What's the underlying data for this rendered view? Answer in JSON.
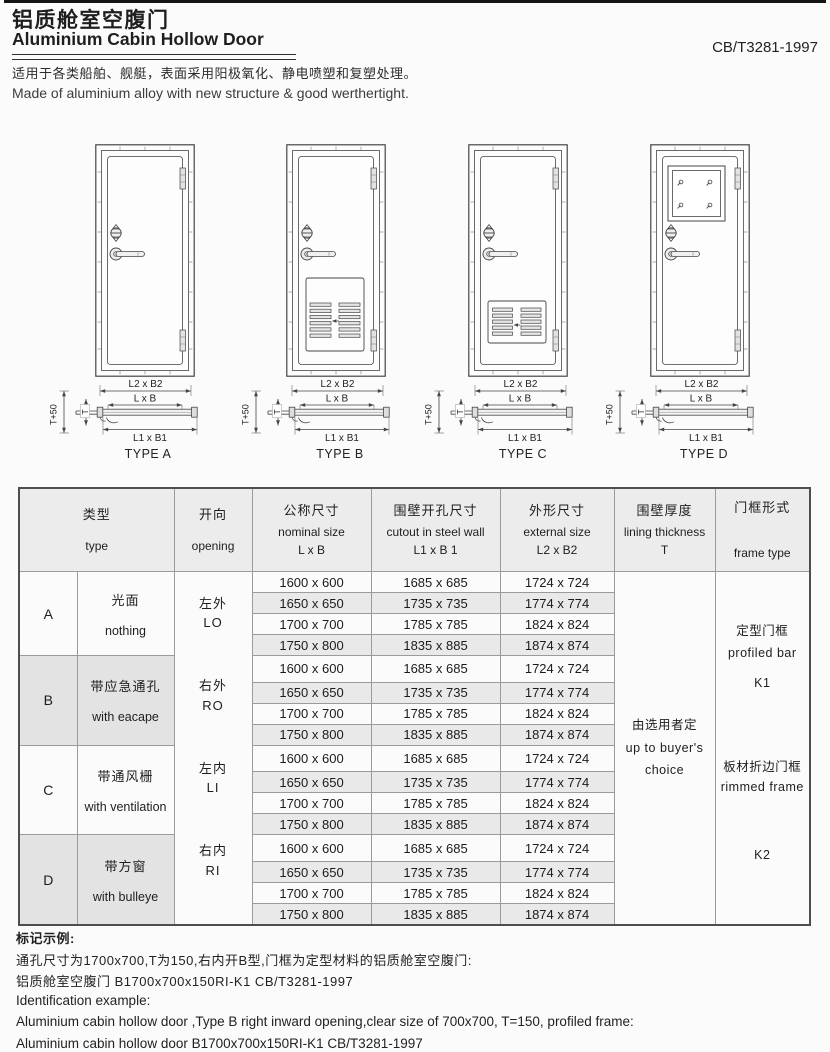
{
  "header": {
    "title_zh": "铝质舱室空腹门",
    "title_en": "Aluminium Cabin Hollow Door",
    "standard_code": "CB/T3281-1997",
    "description_zh": "适用于各类船舶、舰艇，表面采用阳极氧化、静电喷塑和复塑处理。",
    "description_en": "Made of aluminium alloy with new structure & good werthertight."
  },
  "diagrams": {
    "dimension_labels": {
      "external": "L2 x B2",
      "nominal": "L x B",
      "cutout": "L1 x B1",
      "wall_thickness_plus": "T+50",
      "wall_thickness": "T"
    },
    "types": [
      {
        "id": "A",
        "label": "TYPE A",
        "feature": "plain-door"
      },
      {
        "id": "B",
        "label": "TYPE B",
        "feature": "escape-louver-panel"
      },
      {
        "id": "C",
        "label": "TYPE C",
        "feature": "ventilation-louver-panel"
      },
      {
        "id": "D",
        "label": "TYPE D",
        "feature": "square-window"
      }
    ]
  },
  "table": {
    "headers": {
      "type": {
        "zh": "类型",
        "en": "type"
      },
      "opening": {
        "zh": "开向",
        "en": "opening"
      },
      "nominal": {
        "zh": "公称尺寸",
        "en": "nominal size",
        "sub": "L x B"
      },
      "cutout": {
        "zh": "围壁开孔尺寸",
        "en": "cutout in steel wall",
        "sub": "L1 x B 1"
      },
      "external": {
        "zh": "外形尺寸",
        "en": "external size",
        "sub": "L2 x B2"
      },
      "lining": {
        "zh": "围壁厚度",
        "en": "lining thickness",
        "sub": "T"
      },
      "frame": {
        "zh": "门框形式",
        "en": "frame type"
      }
    },
    "openings": [
      {
        "zh": "左外",
        "code": "LO"
      },
      {
        "zh": "右外",
        "code": "RO"
      },
      {
        "zh": "左内",
        "code": "LI"
      },
      {
        "zh": "右内",
        "code": "RI"
      }
    ],
    "sections": [
      {
        "letter": "A",
        "desc_zh": "光面",
        "desc_en": "nothing",
        "rows": [
          [
            "1600 x 600",
            "1685 x 685",
            "1724 x 724"
          ],
          [
            "1650 x 650",
            "1735 x 735",
            "1774 x 774"
          ],
          [
            "1700 x 700",
            "1785 x 785",
            "1824 x 824"
          ],
          [
            "1750 x 800",
            "1835 x 885",
            "1874 x 874"
          ]
        ]
      },
      {
        "letter": "B",
        "desc_zh": "带应急通孔",
        "desc_en": "with eacape",
        "rows": [
          [
            "1600 x 600",
            "1685 x 685",
            "1724 x 724"
          ],
          [
            "1650 x 650",
            "1735 x 735",
            "1774 x 774"
          ],
          [
            "1700 x 700",
            "1785 x 785",
            "1824 x 824"
          ],
          [
            "1750 x 800",
            "1835 x 885",
            "1874 x 874"
          ]
        ]
      },
      {
        "letter": "C",
        "desc_zh": "带通风栅",
        "desc_en": "with ventilation",
        "rows": [
          [
            "1600 x 600",
            "1685 x 685",
            "1724 x 724"
          ],
          [
            "1650 x 650",
            "1735 x 735",
            "1774 x 774"
          ],
          [
            "1700 x 700",
            "1785 x 785",
            "1824 x 824"
          ],
          [
            "1750 x 800",
            "1835 x 885",
            "1874 x 874"
          ]
        ]
      },
      {
        "letter": "D",
        "desc_zh": "带方窗",
        "desc_en": "with bulleye",
        "rows": [
          [
            "1600 x 600",
            "1685 x 685",
            "1724 x 724"
          ],
          [
            "1650 x 650",
            "1735 x 735",
            "1774 x 774"
          ],
          [
            "1700 x 700",
            "1785 x 785",
            "1824 x 824"
          ],
          [
            "1750 x 800",
            "1835 x 885",
            "1874 x 874"
          ]
        ]
      }
    ],
    "lining_value": {
      "zh": "由选用者定",
      "en_line1": "up to buyer's",
      "en_line2": "choice"
    },
    "frame_types": [
      {
        "zh": "定型门框",
        "en": "profiled bar",
        "code": "K1"
      },
      {
        "zh": "板材折边门框",
        "en": "rimmed frame",
        "code": "K2"
      }
    ]
  },
  "footer": {
    "mark_title_zh": "标记示例:",
    "zh_line1": "通孔尺寸为1700x700,T为150,右内开B型,门框为定型材料的铝质舱室空腹门:",
    "zh_line2": "铝质舱室空腹门 B1700x700x150RI-K1 CB/T3281-1997",
    "mark_title_en": "Identification example:",
    "en_line1": "Aluminium cabin hollow door ,Type B right inward opening,clear size of 700x700, T=150, profiled frame:",
    "en_line2": "Aluminium cabin hollow door B1700x700x150RI-K1 CB/T3281-1997"
  },
  "colors": {
    "page_bg": "#fbfbfb",
    "header_bg": "#ececec",
    "row_shade": "#e9e9e9",
    "section_shade": "#e3e3e3",
    "line": "#454545"
  }
}
